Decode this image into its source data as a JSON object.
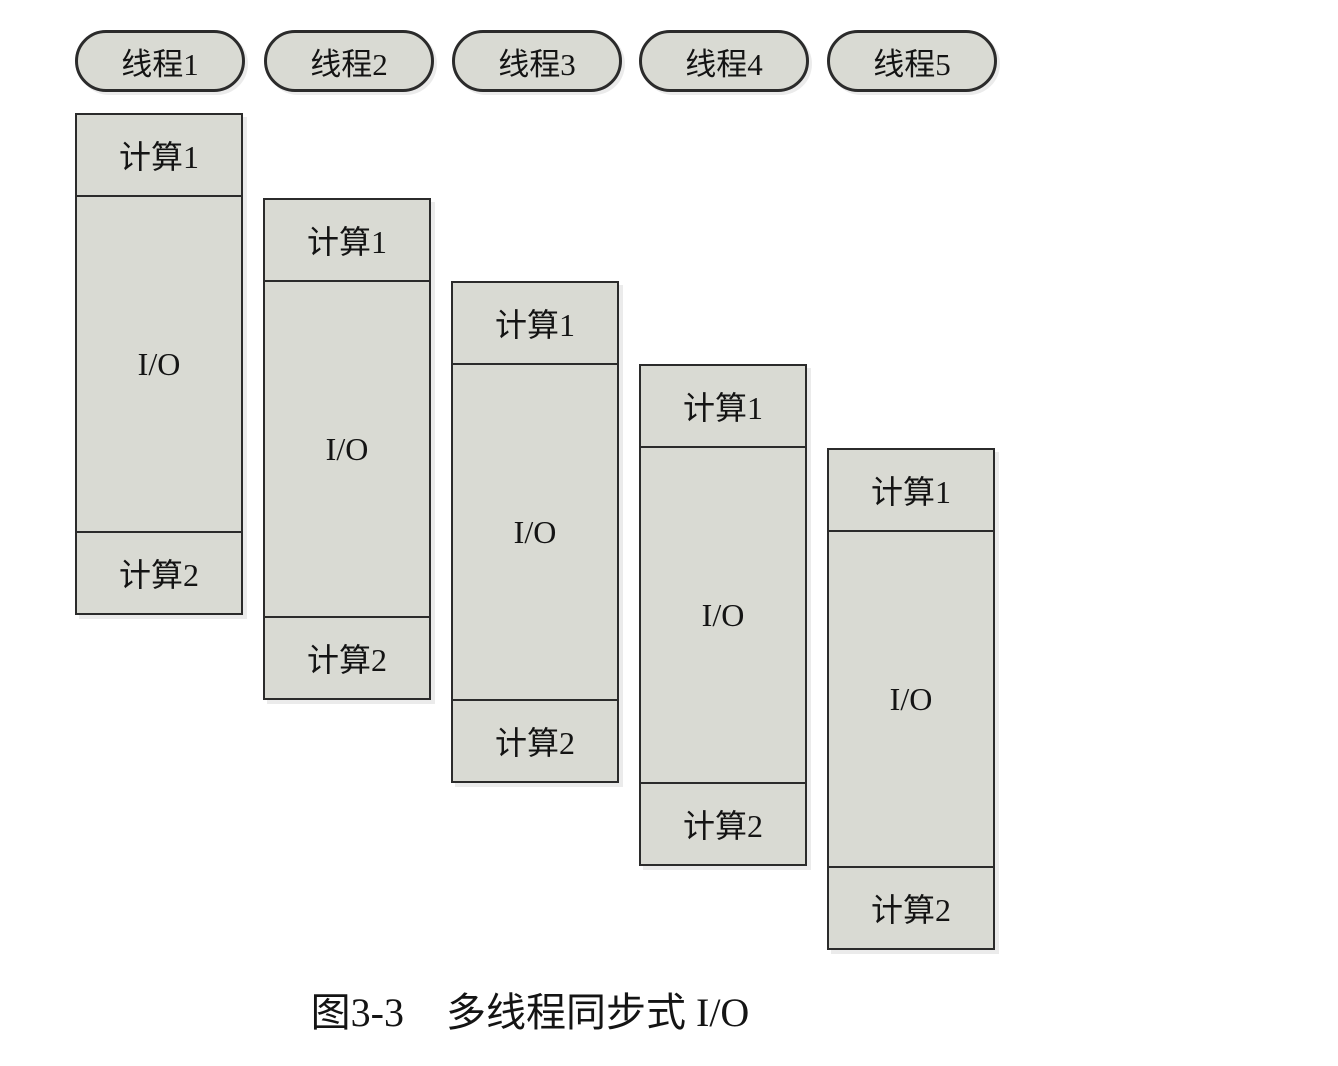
{
  "figure": {
    "caption_label": "图3-3",
    "caption_title": "多线程同步式 I/O"
  },
  "colors": {
    "box_fill": "#d9dad3",
    "box_border": "#2b2b2b",
    "text": "#141414",
    "background": "#ffffff"
  },
  "threads": [
    {
      "name": "线程1",
      "segments": [
        "计算1",
        "I/O",
        "计算2"
      ]
    },
    {
      "name": "线程2",
      "segments": [
        "计算1",
        "I/O",
        "计算2"
      ]
    },
    {
      "name": "线程3",
      "segments": [
        "计算1",
        "I/O",
        "计算2"
      ]
    },
    {
      "name": "线程4",
      "segments": [
        "计算1",
        "I/O",
        "计算2"
      ]
    },
    {
      "name": "线程5",
      "segments": [
        "计算1",
        "I/O",
        "计算2"
      ]
    }
  ]
}
